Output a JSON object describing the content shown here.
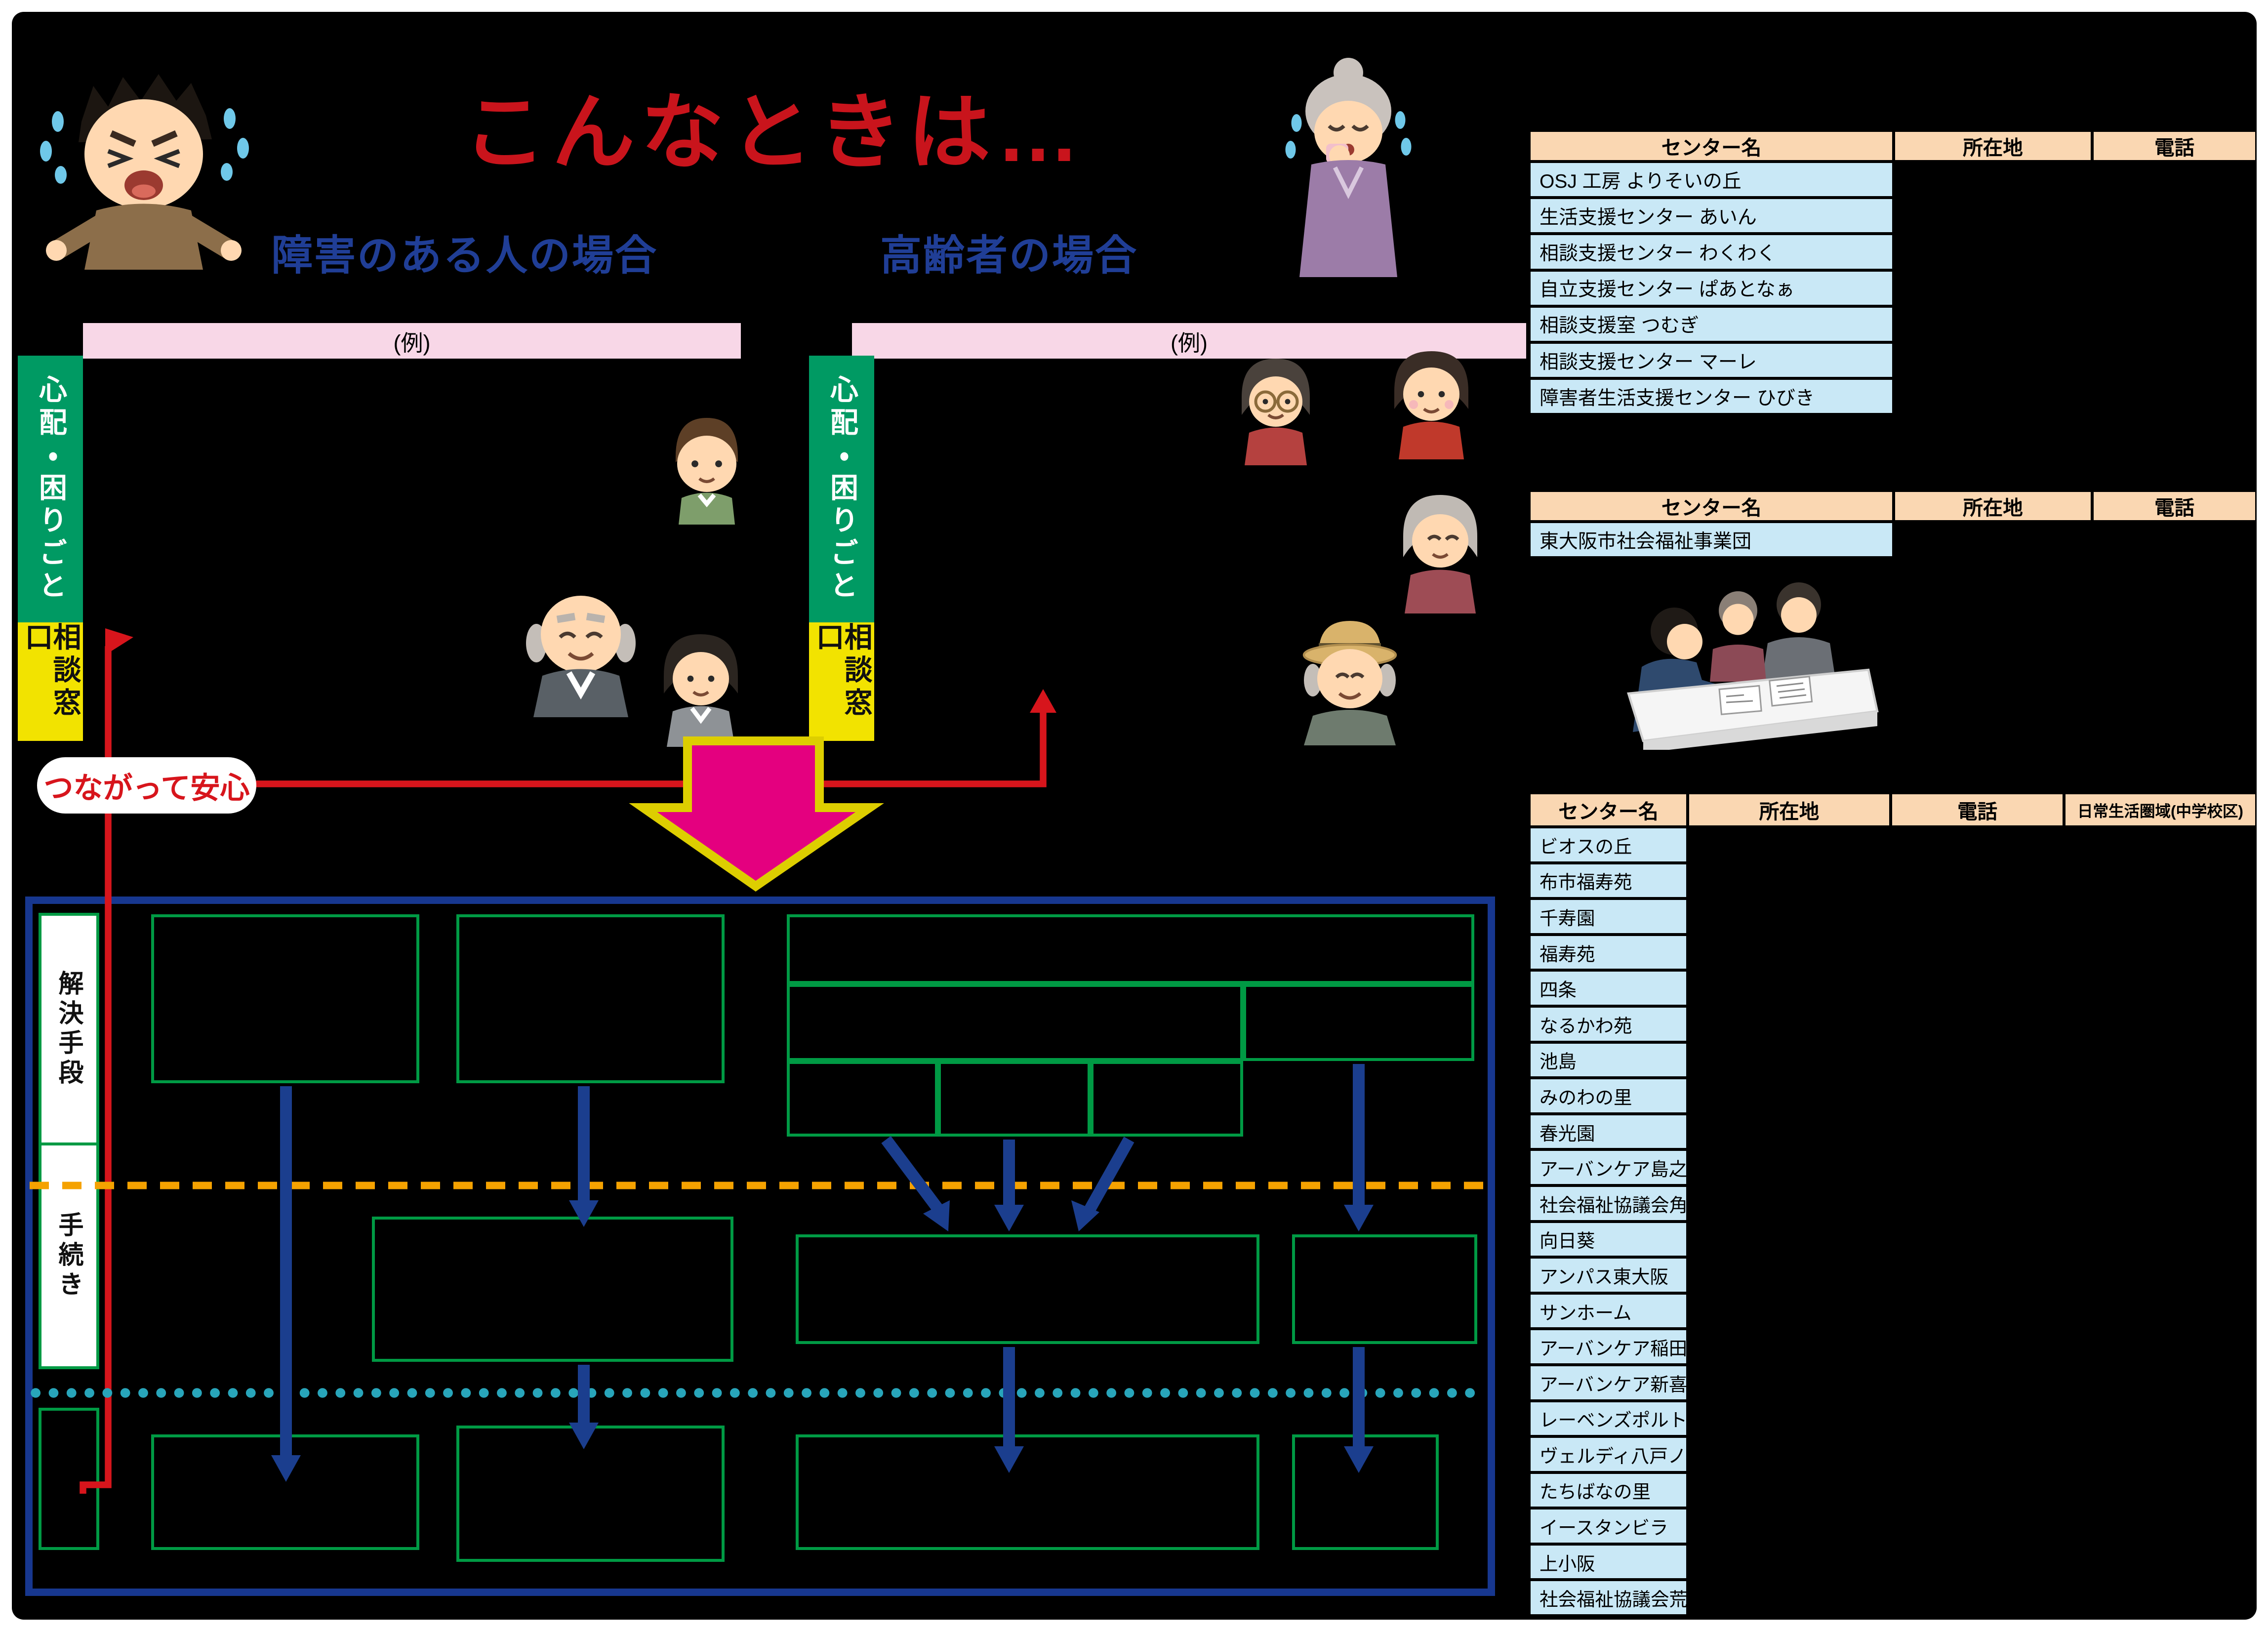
{
  "title": "こんなときは…",
  "headings": {
    "disabled": "障害のある人の場合",
    "elderly": "高齢者の場合"
  },
  "labels": {
    "example": "(例)",
    "worry": "心配・困りごと",
    "counter_window": "相談窓口",
    "connected": "つながって安心",
    "solution": "解決手段",
    "procedure": "手続き"
  },
  "tables": [
    {
      "name": "disability-support-centers",
      "headers": [
        "センター名",
        "所在地",
        "電話"
      ],
      "rows": [
        "OSJ 工房 よりそいの丘",
        "生活支援センター あいん",
        "相談支援センター わくわく",
        "自立支援センター ぱあとなぁ",
        "相談支援室 つむぎ",
        "相談支援センター マーレ",
        "障害者生活支援センター ひびき"
      ]
    },
    {
      "name": "welfare-organization",
      "headers": [
        "センター名",
        "所在地",
        "電話"
      ],
      "rows": [
        "東大阪市社会福祉事業団"
      ]
    },
    {
      "name": "elderly-support-centers",
      "headers": [
        "センター名",
        "所在地",
        "電話",
        "日常生活圏域(中学校区)"
      ],
      "rows": [
        "ビオスの丘",
        "布市福寿苑",
        "千寿園",
        "福寿苑",
        "四条",
        "なるかわ苑",
        "池島",
        "みのわの里",
        "春光園",
        "アーバンケア島之内",
        "社会福祉協議会角田",
        "向日葵",
        "アンパス東大阪",
        "サンホーム",
        "アーバンケア稲田",
        "アーバンケア新喜多",
        "レーベンズポルト",
        "ヴェルディ八戸ノ里",
        "たちばなの里",
        "イースタンビラ",
        "上小阪",
        "社会福祉協議会荒川"
      ]
    }
  ],
  "colors": {
    "title_red": "#c9141c",
    "heading_blue": "#203e96",
    "bar_green": "#009a63",
    "bar_yellow": "#f2e300",
    "example_pink": "#f8d7e7",
    "table_header_peach": "#fad7b2",
    "table_row_blue": "#c9e8f6",
    "magenta_arrow": "#e4007f",
    "magenta_arrow_outline": "#ddce00",
    "flow_arrow_blue": "#1b3e8e",
    "outer_box_blue": "#17378f",
    "green_border": "#009a44",
    "orange_dashed": "#f5a200",
    "cyan_dotted": "#28a5ba",
    "red_line": "#d7151c"
  },
  "illustrations": [
    "crying-man",
    "crying-elderly-woman",
    "boy",
    "old-man",
    "suit-woman",
    "glasses-woman",
    "red-top-woman",
    "elderly-woman",
    "hat-elderly-man",
    "reception-counter"
  ]
}
